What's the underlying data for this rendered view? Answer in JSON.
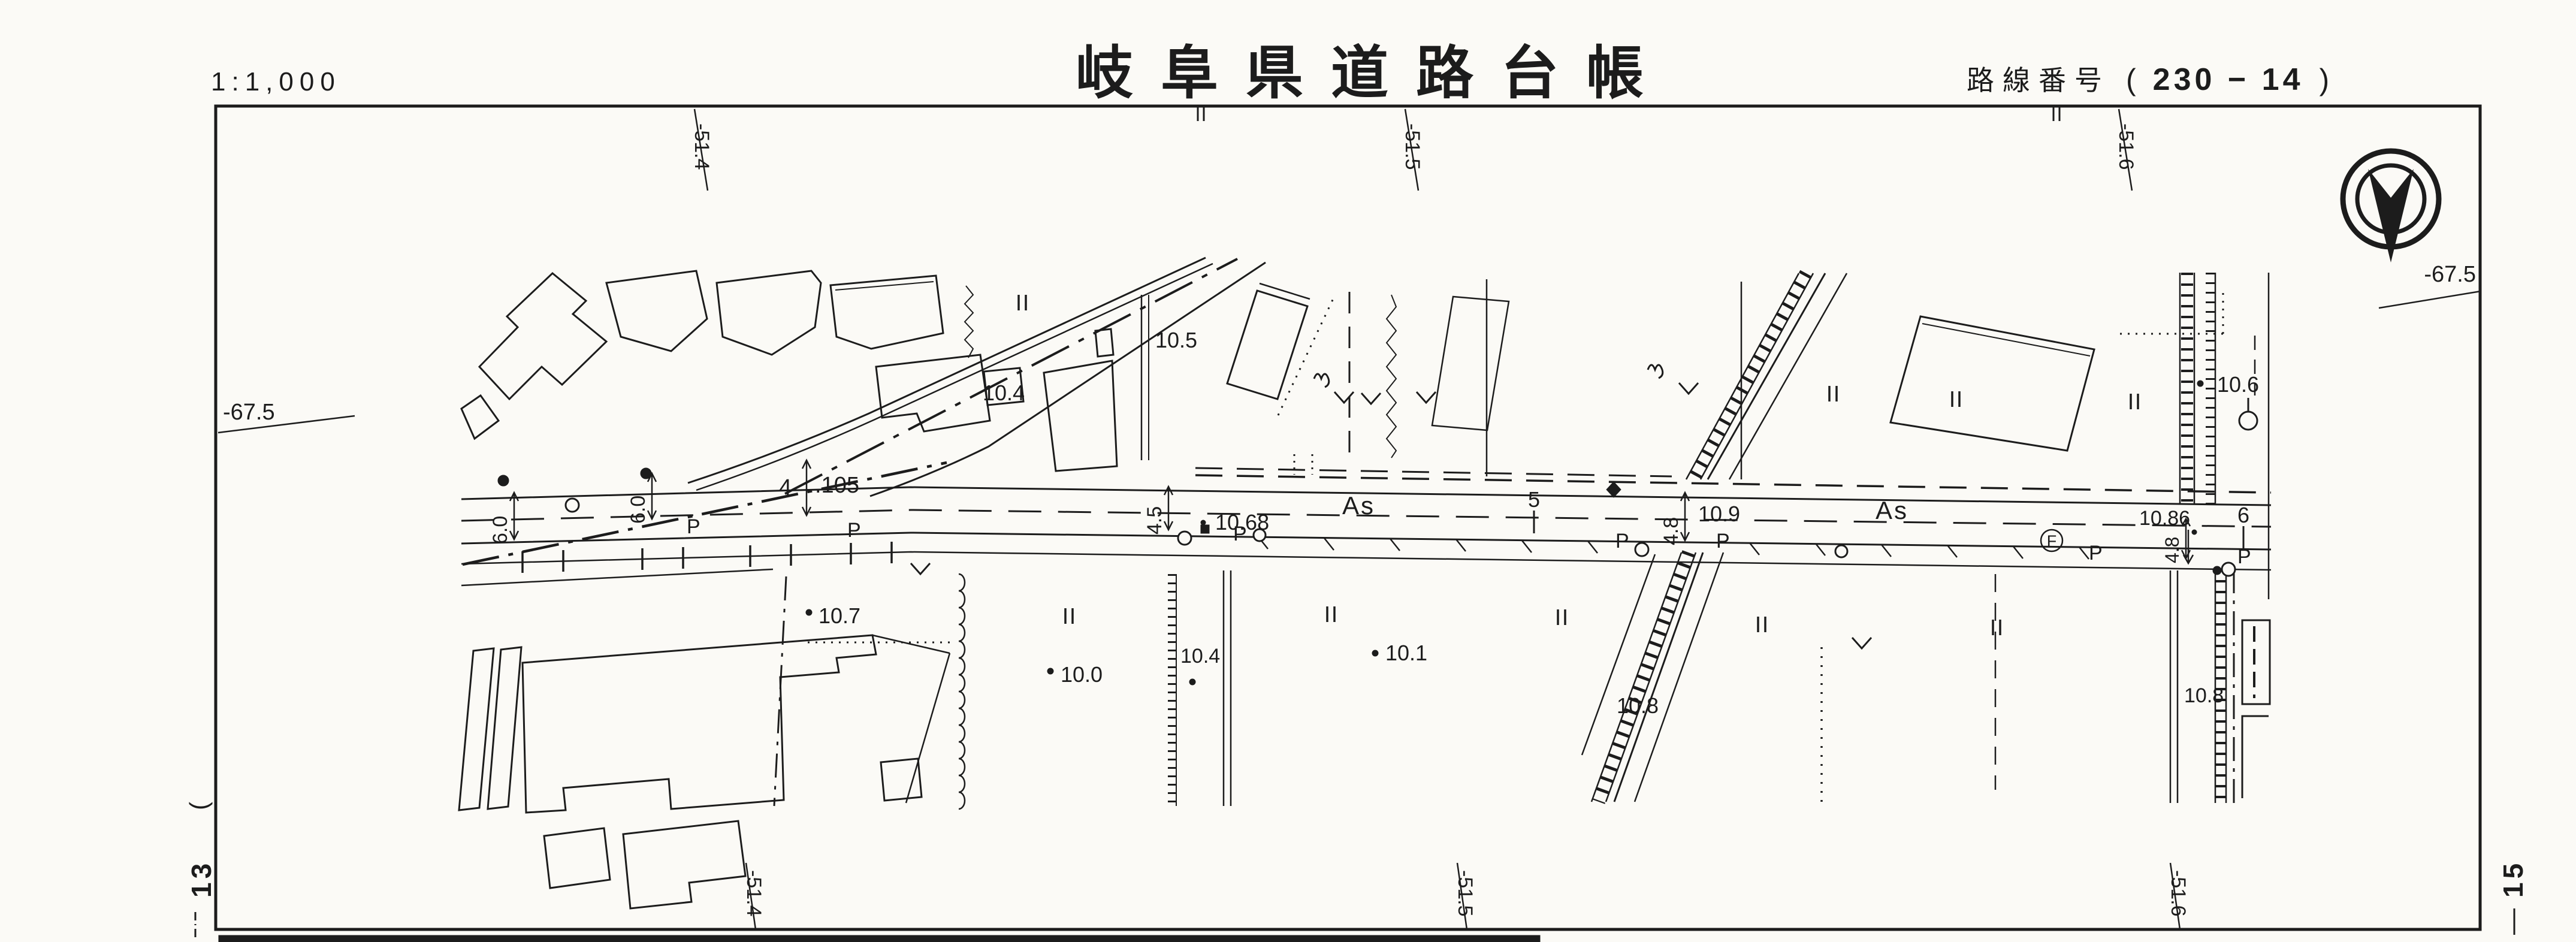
{
  "colors": {
    "ink": "#1c1c1c",
    "paper": "#fbfaf6"
  },
  "header": {
    "scale": "1:1,000",
    "title": "岐阜県道路台帳",
    "route_label": "路線番号",
    "route_open": "(",
    "route_value": "230 − 14",
    "route_close": ")"
  },
  "grid": {
    "top": [
      "-51.4",
      "-51.5",
      "-51.6"
    ],
    "bottom": [
      "-51.4",
      "-51.5",
      "-51.6"
    ],
    "left": "-67.5",
    "right": "-67.5",
    "sheet_prev": "13",
    "sheet_next": "15",
    "paren": "("
  },
  "road": {
    "surface": [
      "As",
      "As"
    ],
    "station_4": "4",
    "station_4_offset": ".105",
    "station_5": "5",
    "station_6": "6",
    "widths": [
      "6.0",
      "6.0",
      "4.5",
      "4.8",
      "4.8"
    ],
    "p_markers": [
      "P",
      "P",
      "P",
      "P",
      "P",
      "P",
      "P"
    ],
    "circled_f": "F"
  },
  "spots": [
    {
      "label": "10.4"
    },
    {
      "label": "10.5"
    },
    {
      "label": "10.68"
    },
    {
      "label": "10.9"
    },
    {
      "label": "10.86"
    },
    {
      "label": "10.6"
    },
    {
      "label": "10.7"
    },
    {
      "label": "10.0"
    },
    {
      "label": "10.4"
    },
    {
      "label": "10.1"
    },
    {
      "label": "10.8"
    },
    {
      "label": "10.8"
    }
  ]
}
